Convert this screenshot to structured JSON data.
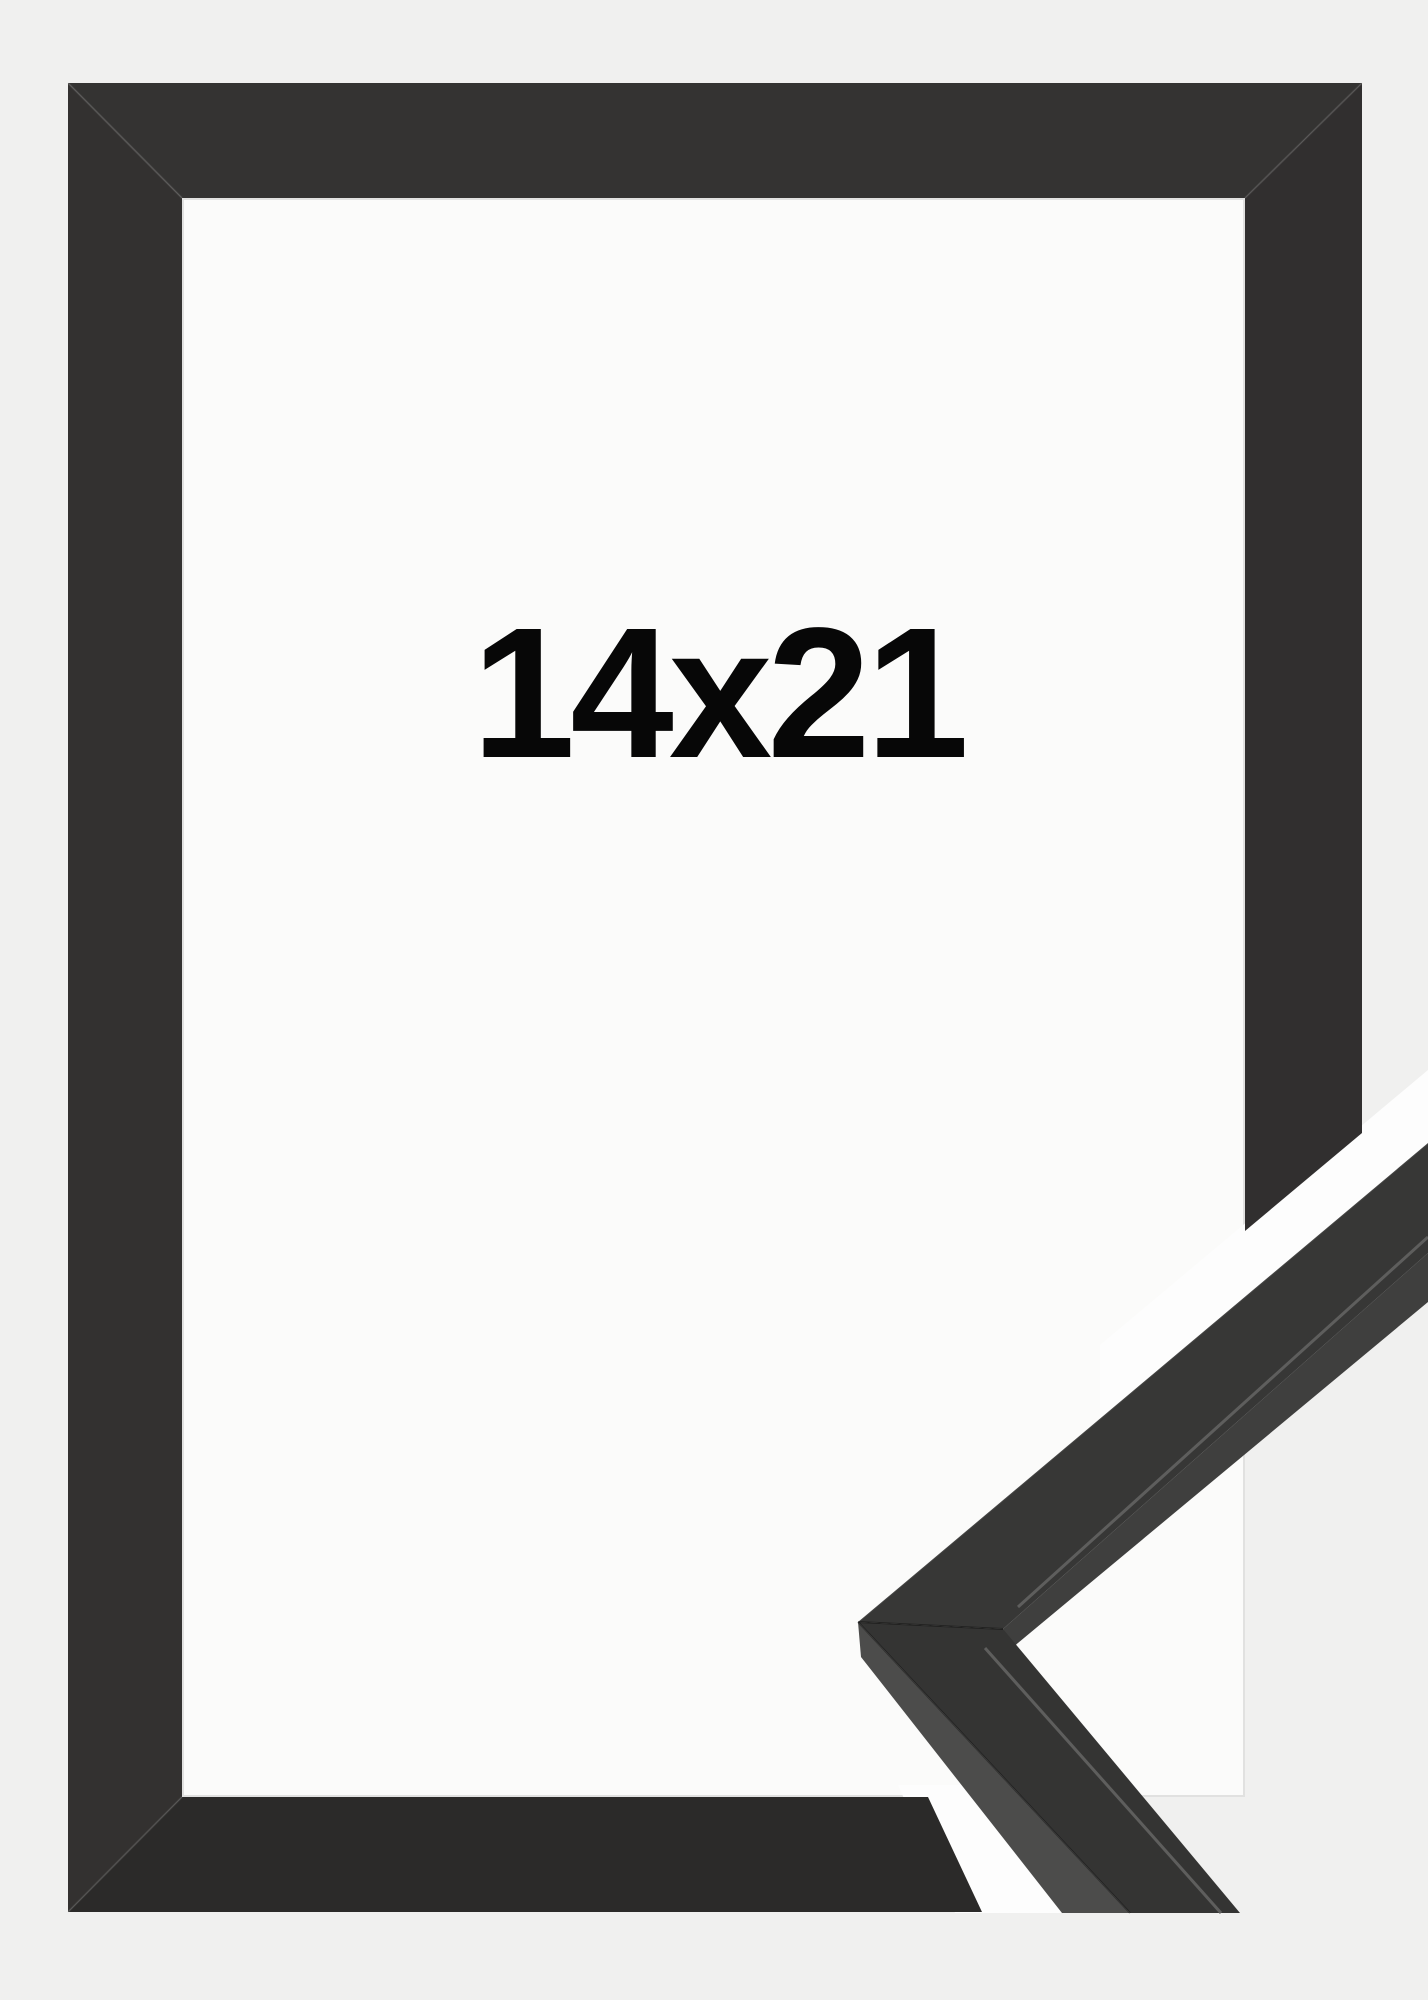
{
  "product": {
    "size_label": "14x21",
    "colors": {
      "background": "#f0f0ef",
      "interior": "#fbfbfa",
      "gap_white": "#fdfdfd",
      "frame_top": "#343332",
      "frame_left": "#333130",
      "frame_right": "#312f2f",
      "frame_bottom": "#2b2a29",
      "arm_face_upper": "#373736",
      "arm_face_lower": "#343433",
      "arm_under": "#3f3f3e",
      "arm_side": "#4c4c4b",
      "lip_highlight": "#5e5e5d",
      "label_text": "#070707"
    }
  }
}
